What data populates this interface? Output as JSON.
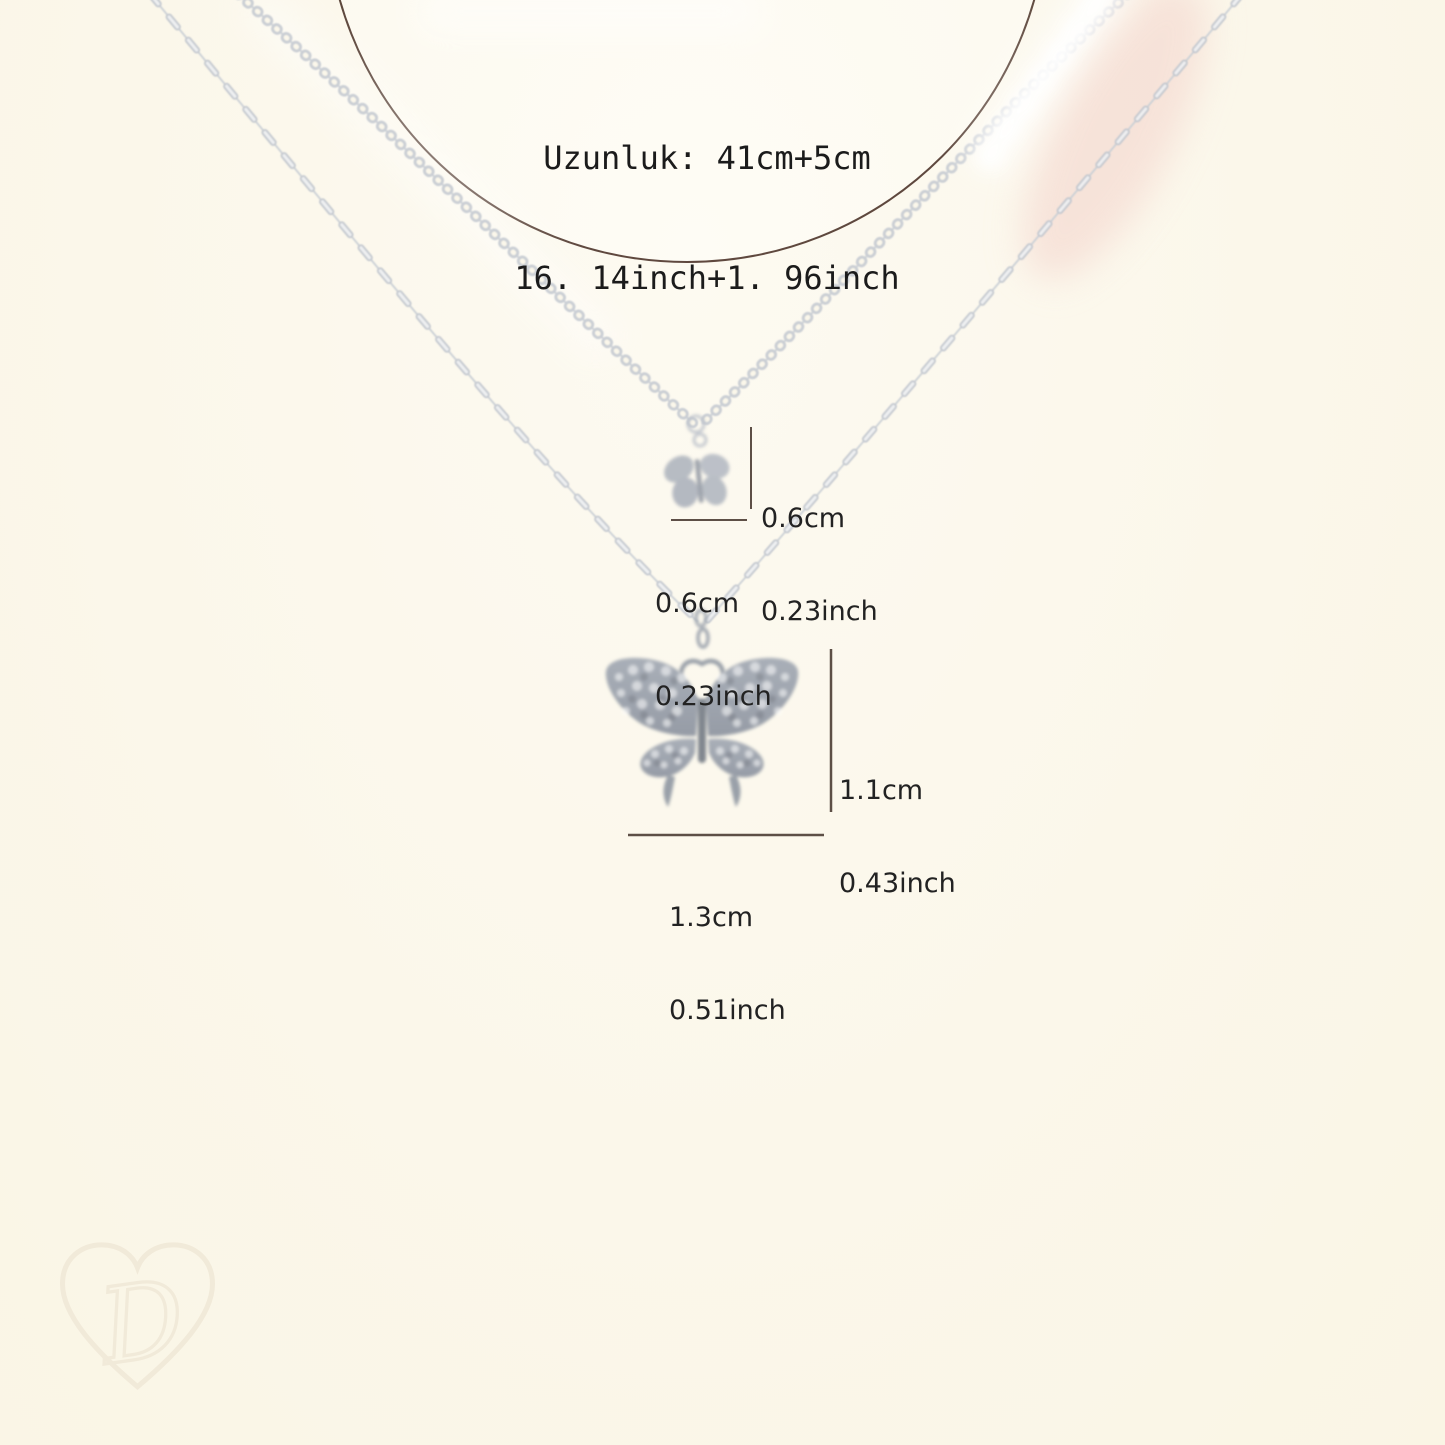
{
  "size_chart": {
    "length": {
      "line1": "Uzunluk: 41cm+5cm",
      "line2": "16. 14inch+1. 96inch"
    },
    "small_pendant": {
      "height_cm": "0.6cm",
      "height_inch": "0.23inch",
      "width_cm": "0.6cm",
      "width_inch": "0.23inch"
    },
    "large_pendant": {
      "height_cm": "1.1cm",
      "height_inch": "0.43inch",
      "width_cm": "1.3cm",
      "width_inch": "0.51inch"
    }
  },
  "watermark": {
    "letter": "D"
  },
  "colors": {
    "background": "#fbf7ea",
    "chain_silver": "#c6cbd2",
    "pendant_silver": "#a3a9b2",
    "circle_line": "#4e352b",
    "dimension_line": "#4c3d34",
    "text": "#1d1d1d",
    "watermark": "#f1ead9",
    "blush_highlight": "#f5dcd3"
  }
}
